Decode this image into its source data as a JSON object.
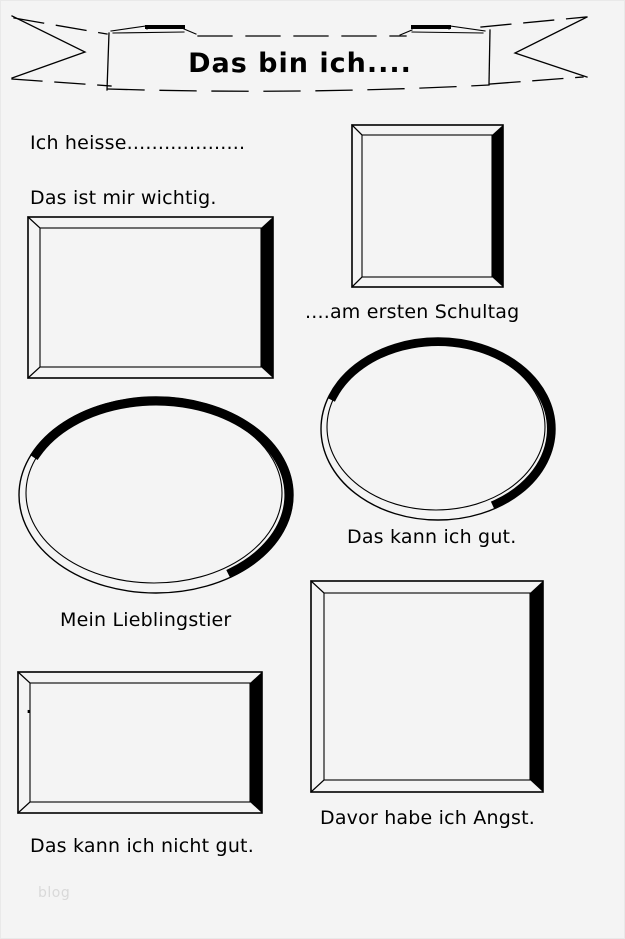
{
  "page": {
    "title": "Das bin ich....",
    "watermark": "blog",
    "background_color": "#f4f4f4",
    "ink_color": "#000000",
    "watermark_color": "#d9d9d9"
  },
  "labels": {
    "name_line": "Ich heisse...................",
    "important": "Das ist mir wichtig.",
    "first_school_day": "....am ersten Schultag",
    "good_at": "Das kann ich gut.",
    "favorite_animal": "Mein Lieblingstier",
    "not_good_at": "Das kann ich nicht gut.",
    "afraid_of": "Davor habe ich Angst.",
    "frame_dot": "."
  }
}
